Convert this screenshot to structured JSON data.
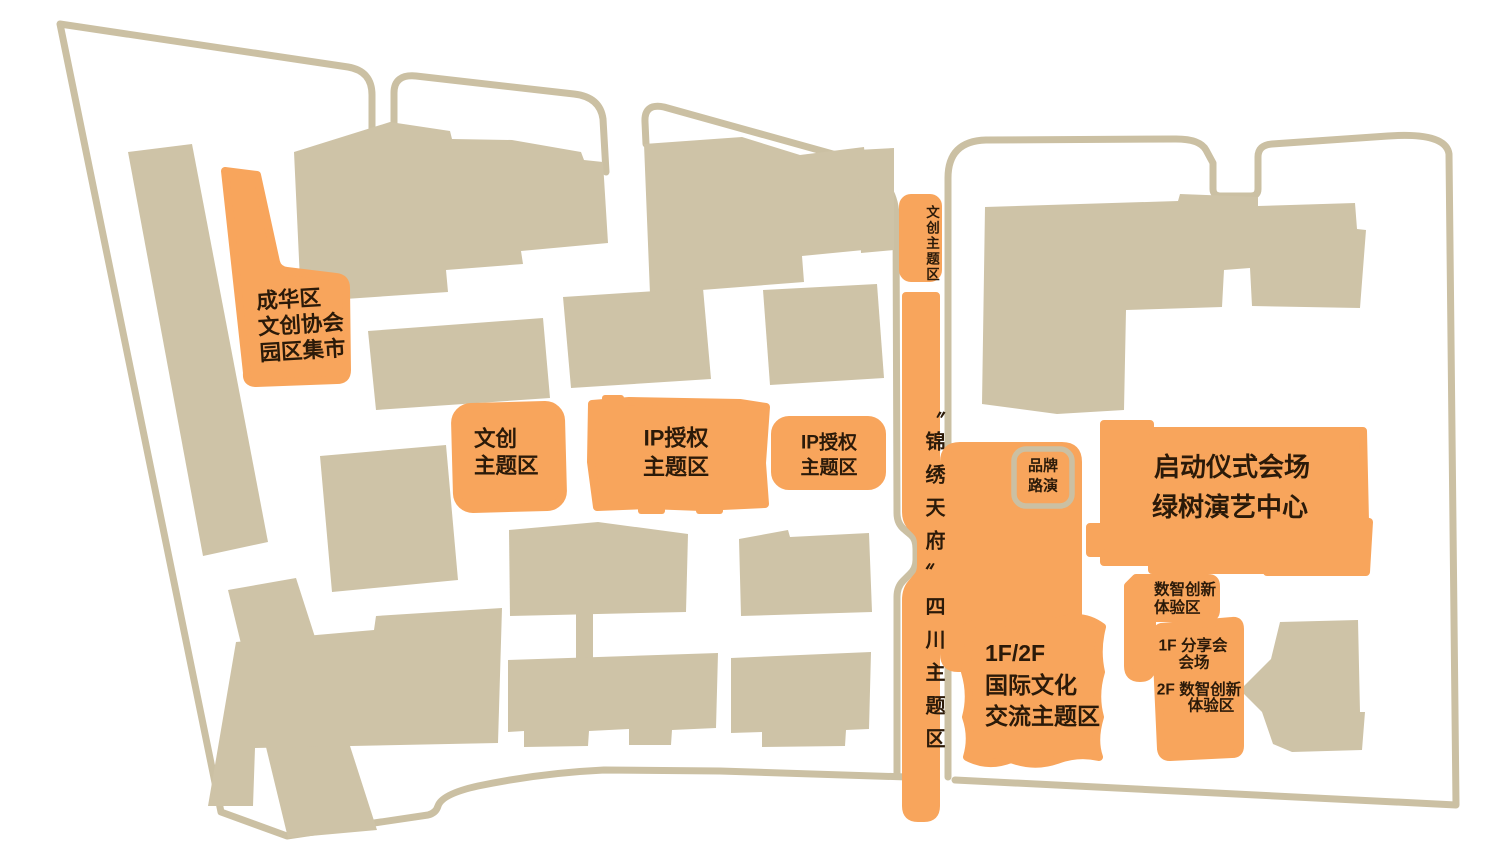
{
  "colors": {
    "zone_orange": "#F8A55C",
    "building_beige": "#CEC3A7",
    "road_beige": "#CBC0A3",
    "label_dark": "#2B1A09",
    "background": "#FFFFFF"
  },
  "zones": {
    "chenghua_market": {
      "lines": [
        "成华区",
        "文创协会",
        "园区集市"
      ]
    },
    "wenchuang_theme": {
      "lines": [
        "文创",
        "主题区"
      ]
    },
    "ip_license_main": {
      "lines": [
        "IP授权",
        "主题区"
      ]
    },
    "ip_license_small": {
      "lines": [
        "IP授权",
        "主题区"
      ]
    },
    "wenchuang_strip": {
      "text": "文创主题区"
    },
    "jinxiu_strip": {
      "text": "〝锦绣天府〞四川主题区"
    },
    "brand_roadshow": {
      "lines": [
        "品牌",
        "路演"
      ]
    },
    "launch_venue": {
      "lines": [
        "启动仪式会场",
        "绿树演艺中心"
      ]
    },
    "digital_experience": {
      "lines": [
        "数智创新",
        "体验区"
      ]
    },
    "intl_exchange": {
      "lines": [
        "1F/2F",
        "国际文化",
        "交流主题区"
      ]
    },
    "sharing_venue": {
      "lines": [
        "1F 分享会",
        "会场"
      ]
    },
    "digital_experience_2f": {
      "lines": [
        "2F 数智创新",
        "体验区"
      ]
    }
  }
}
